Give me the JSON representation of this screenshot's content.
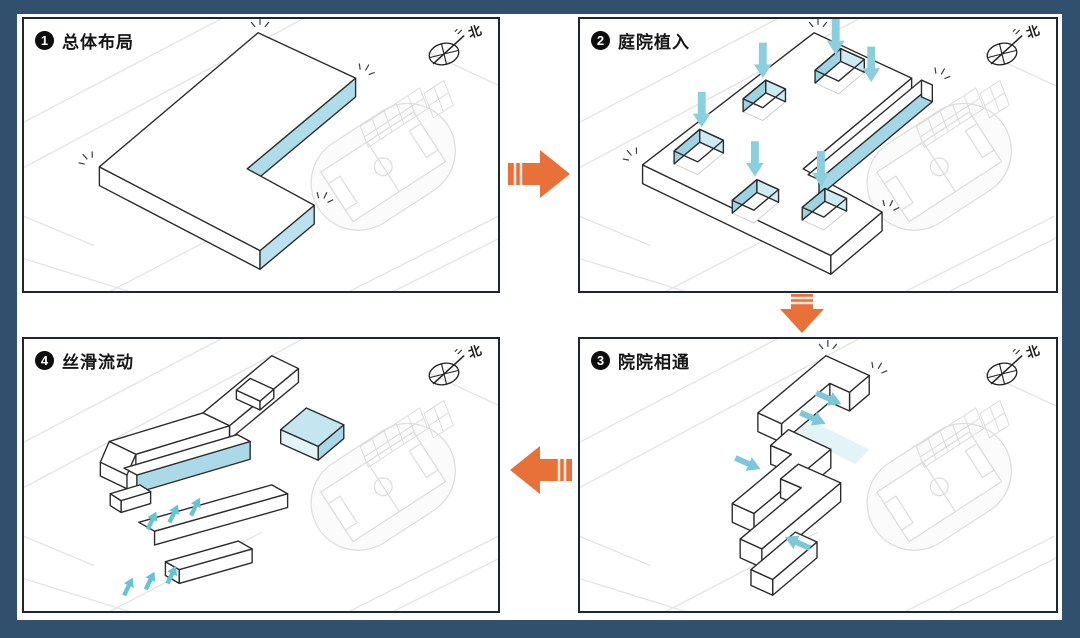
{
  "figure": {
    "type": "architectural-concept-diagram",
    "background_color": "#30506e",
    "panel_count": 4
  },
  "panels": [
    {
      "num": "1",
      "label": "总体布局"
    },
    {
      "num": "2",
      "label": "庭院植入"
    },
    {
      "num": "3",
      "label": "院院相通"
    },
    {
      "num": "4",
      "label": "丝滑流动"
    }
  ],
  "compass": {
    "north_label": "北"
  },
  "flow": {
    "sequence": [
      "panel1-to-panel2-right",
      "panel2-to-panel3-down",
      "panel3-to-panel4-left"
    ],
    "arrow_color": "#e8713a"
  },
  "colors": {
    "accent_blue_face": "#aedce9",
    "courtyard_wall_blue": "#9ed3e2",
    "flow_blue_arrow": "#7cc8d9",
    "panel_border": "#1b2735",
    "building_line": "#2b2b2b",
    "site_line": "#e3e3e3"
  }
}
